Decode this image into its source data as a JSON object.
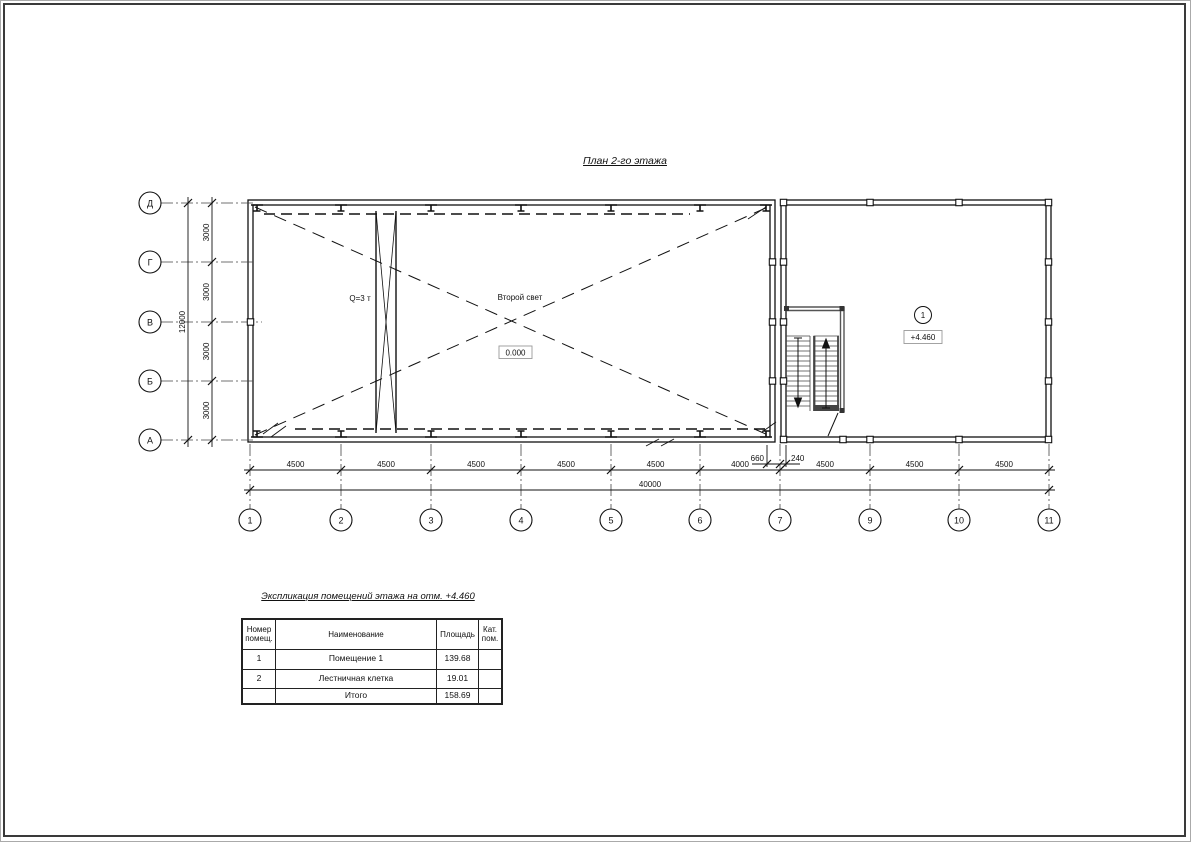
{
  "sheet": {
    "title": "План 2-го этажа"
  },
  "plan": {
    "crane_label": "Q=3 т",
    "void_label": "Второй свет",
    "ground_level": "0.000",
    "room_number": "1",
    "floor_level": "+4.460"
  },
  "axes": {
    "horizontal": [
      "1",
      "2",
      "3",
      "4",
      "5",
      "6",
      "7",
      "9",
      "10",
      "11"
    ],
    "vertical": [
      "Д",
      "Г",
      "В",
      "Б",
      "А"
    ]
  },
  "dims": {
    "bottom": [
      "4500",
      "4500",
      "4500",
      "4500",
      "4500",
      "4000",
      "4500",
      "4500",
      "4500"
    ],
    "bottom_total": "40000",
    "offset_left": "660",
    "offset_right": "240",
    "left": [
      "3000",
      "3000",
      "3000",
      "3000"
    ],
    "left_total": "12000"
  },
  "explication": {
    "title": "Экспликация помещений этажа на отм. +4.460",
    "headers": {
      "number": "Номер\nпомещ.",
      "name": "Наименование",
      "area": "Площадь",
      "category": "Кат.\nпом."
    },
    "rows": [
      {
        "number": "1",
        "name": "Помещение 1",
        "area": "139.68",
        "category": ""
      },
      {
        "number": "2",
        "name": "Лестничная клетка",
        "area": "19.01",
        "category": ""
      }
    ],
    "total_label": "Итого",
    "total_value": "158.69"
  }
}
